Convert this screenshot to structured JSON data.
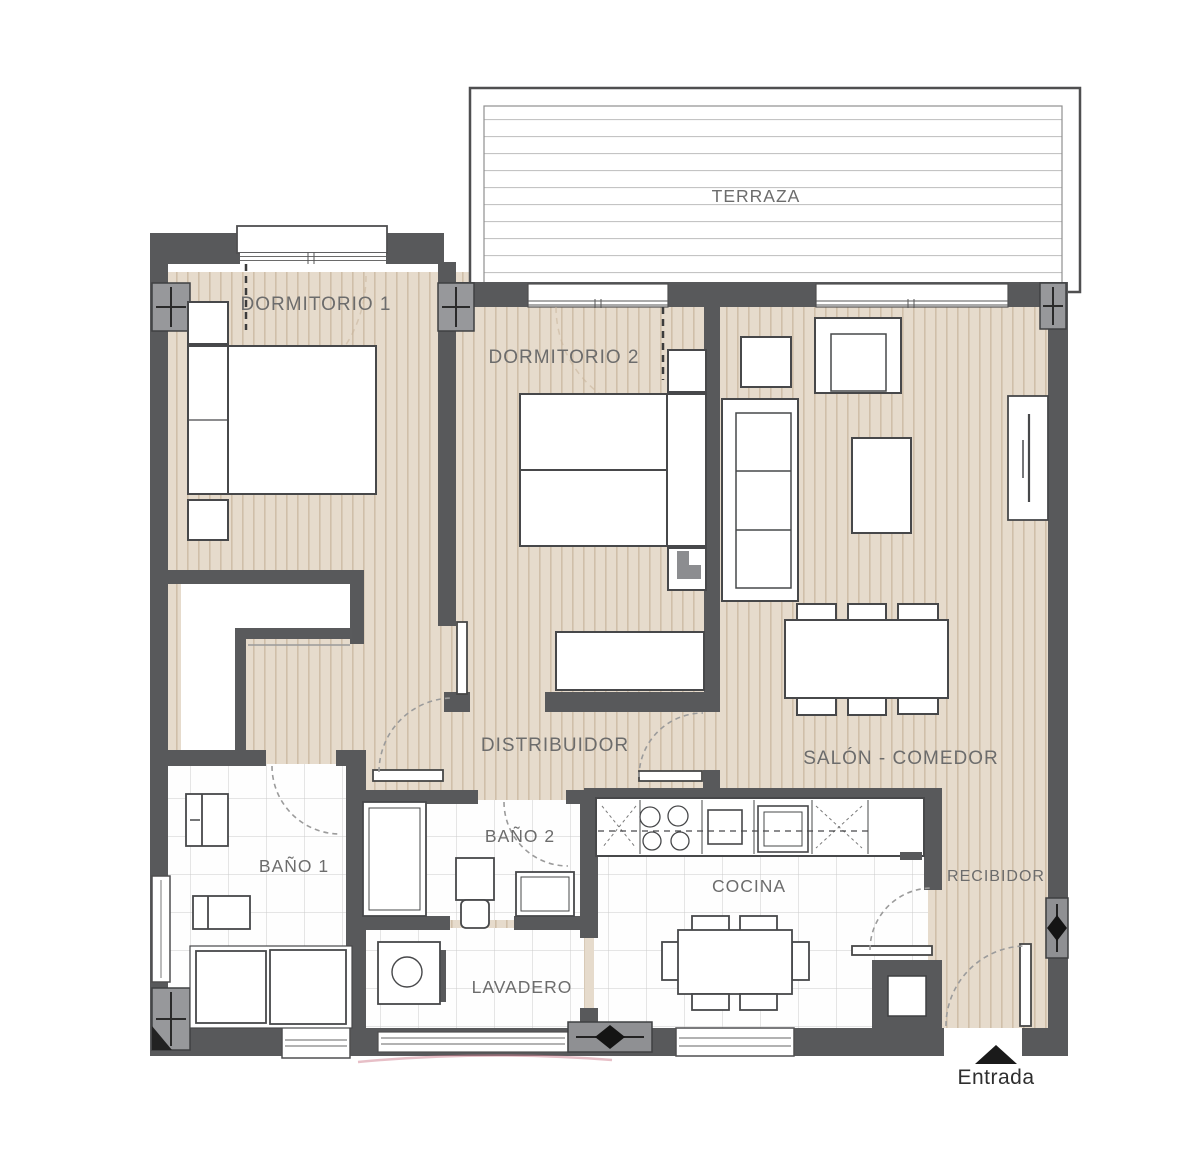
{
  "plan": {
    "type": "apartment-floor-plan",
    "rooms": {
      "terraza": "TERRAZA",
      "dormitorio1": "DORMITORIO 1",
      "dormitorio2": "DORMITORIO 2",
      "distribuidor": "DISTRIBUIDOR",
      "salon_comedor": "SALÓN - COMEDOR",
      "bano1": "BAÑO 1",
      "bano2": "BAÑO 2",
      "cocina": "COCINA",
      "lavadero": "LAVADERO",
      "recibidor": "RECIBIDOR"
    },
    "entrance_label": "Entrada",
    "colors": {
      "wall": "#58595b",
      "wood_floor": "#e6dbcc",
      "wood_stripe": "#d0bfa9",
      "tile_floor": "#fefefe",
      "deck_line": "#c4c4c4",
      "label_text": "#6c6c6c",
      "entrance_text": "#2e2e2e"
    }
  }
}
